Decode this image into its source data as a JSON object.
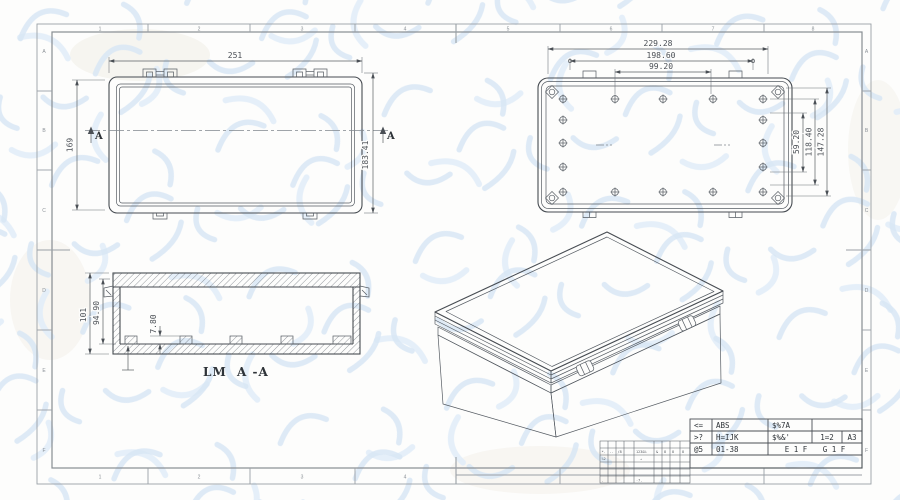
{
  "sheet": {
    "zone_columns": [
      "1",
      "2",
      "3",
      "4",
      "5",
      "6",
      "7",
      "8"
    ],
    "zone_columns_bottom": [
      "1",
      "2",
      "3",
      "4"
    ],
    "zone_rows": [
      "A",
      "B",
      "C",
      "D",
      "E",
      "F"
    ]
  },
  "top_view": {
    "dim_width": "251",
    "dim_height_left": "169",
    "dim_height_right": "183.41",
    "section_letter": "A"
  },
  "back_view": {
    "dim_outer": "229.28",
    "dim_mid": "198.60",
    "dim_inner": "99.20",
    "dim_v_small": "59.20",
    "dim_v_mid": "118.40",
    "dim_v_large": "147.28"
  },
  "section_view": {
    "dim_outer_height": "101",
    "dim_inner_height": "94.90",
    "dim_boss_height": "7.80",
    "label_prefix": "LM",
    "label_section": "A -A"
  },
  "title_block": {
    "r1c1": "<=",
    "r1c2": "ABS",
    "r1c3": "$%7A",
    "r2c1": ">?",
    "r2c2": "H=IJK",
    "r2c3": "$%&'",
    "r2c4": "1=2",
    "r2c5": "A3",
    "r3c1": "@5",
    "r3c2": "01-38",
    "r3c3": "E 1 F",
    "r3c4": "G 1 F",
    "rev": [
      "*.",
      "-.",
      "/8",
      "123&%",
      "&",
      "8",
      "8",
      "8",
      "%2",
      "→",
      "-7.",
      "."
    ]
  },
  "colors": {
    "object_line": "#474c52",
    "frame_line": "#9aa0a6",
    "watermark": "#d9e7f5"
  }
}
